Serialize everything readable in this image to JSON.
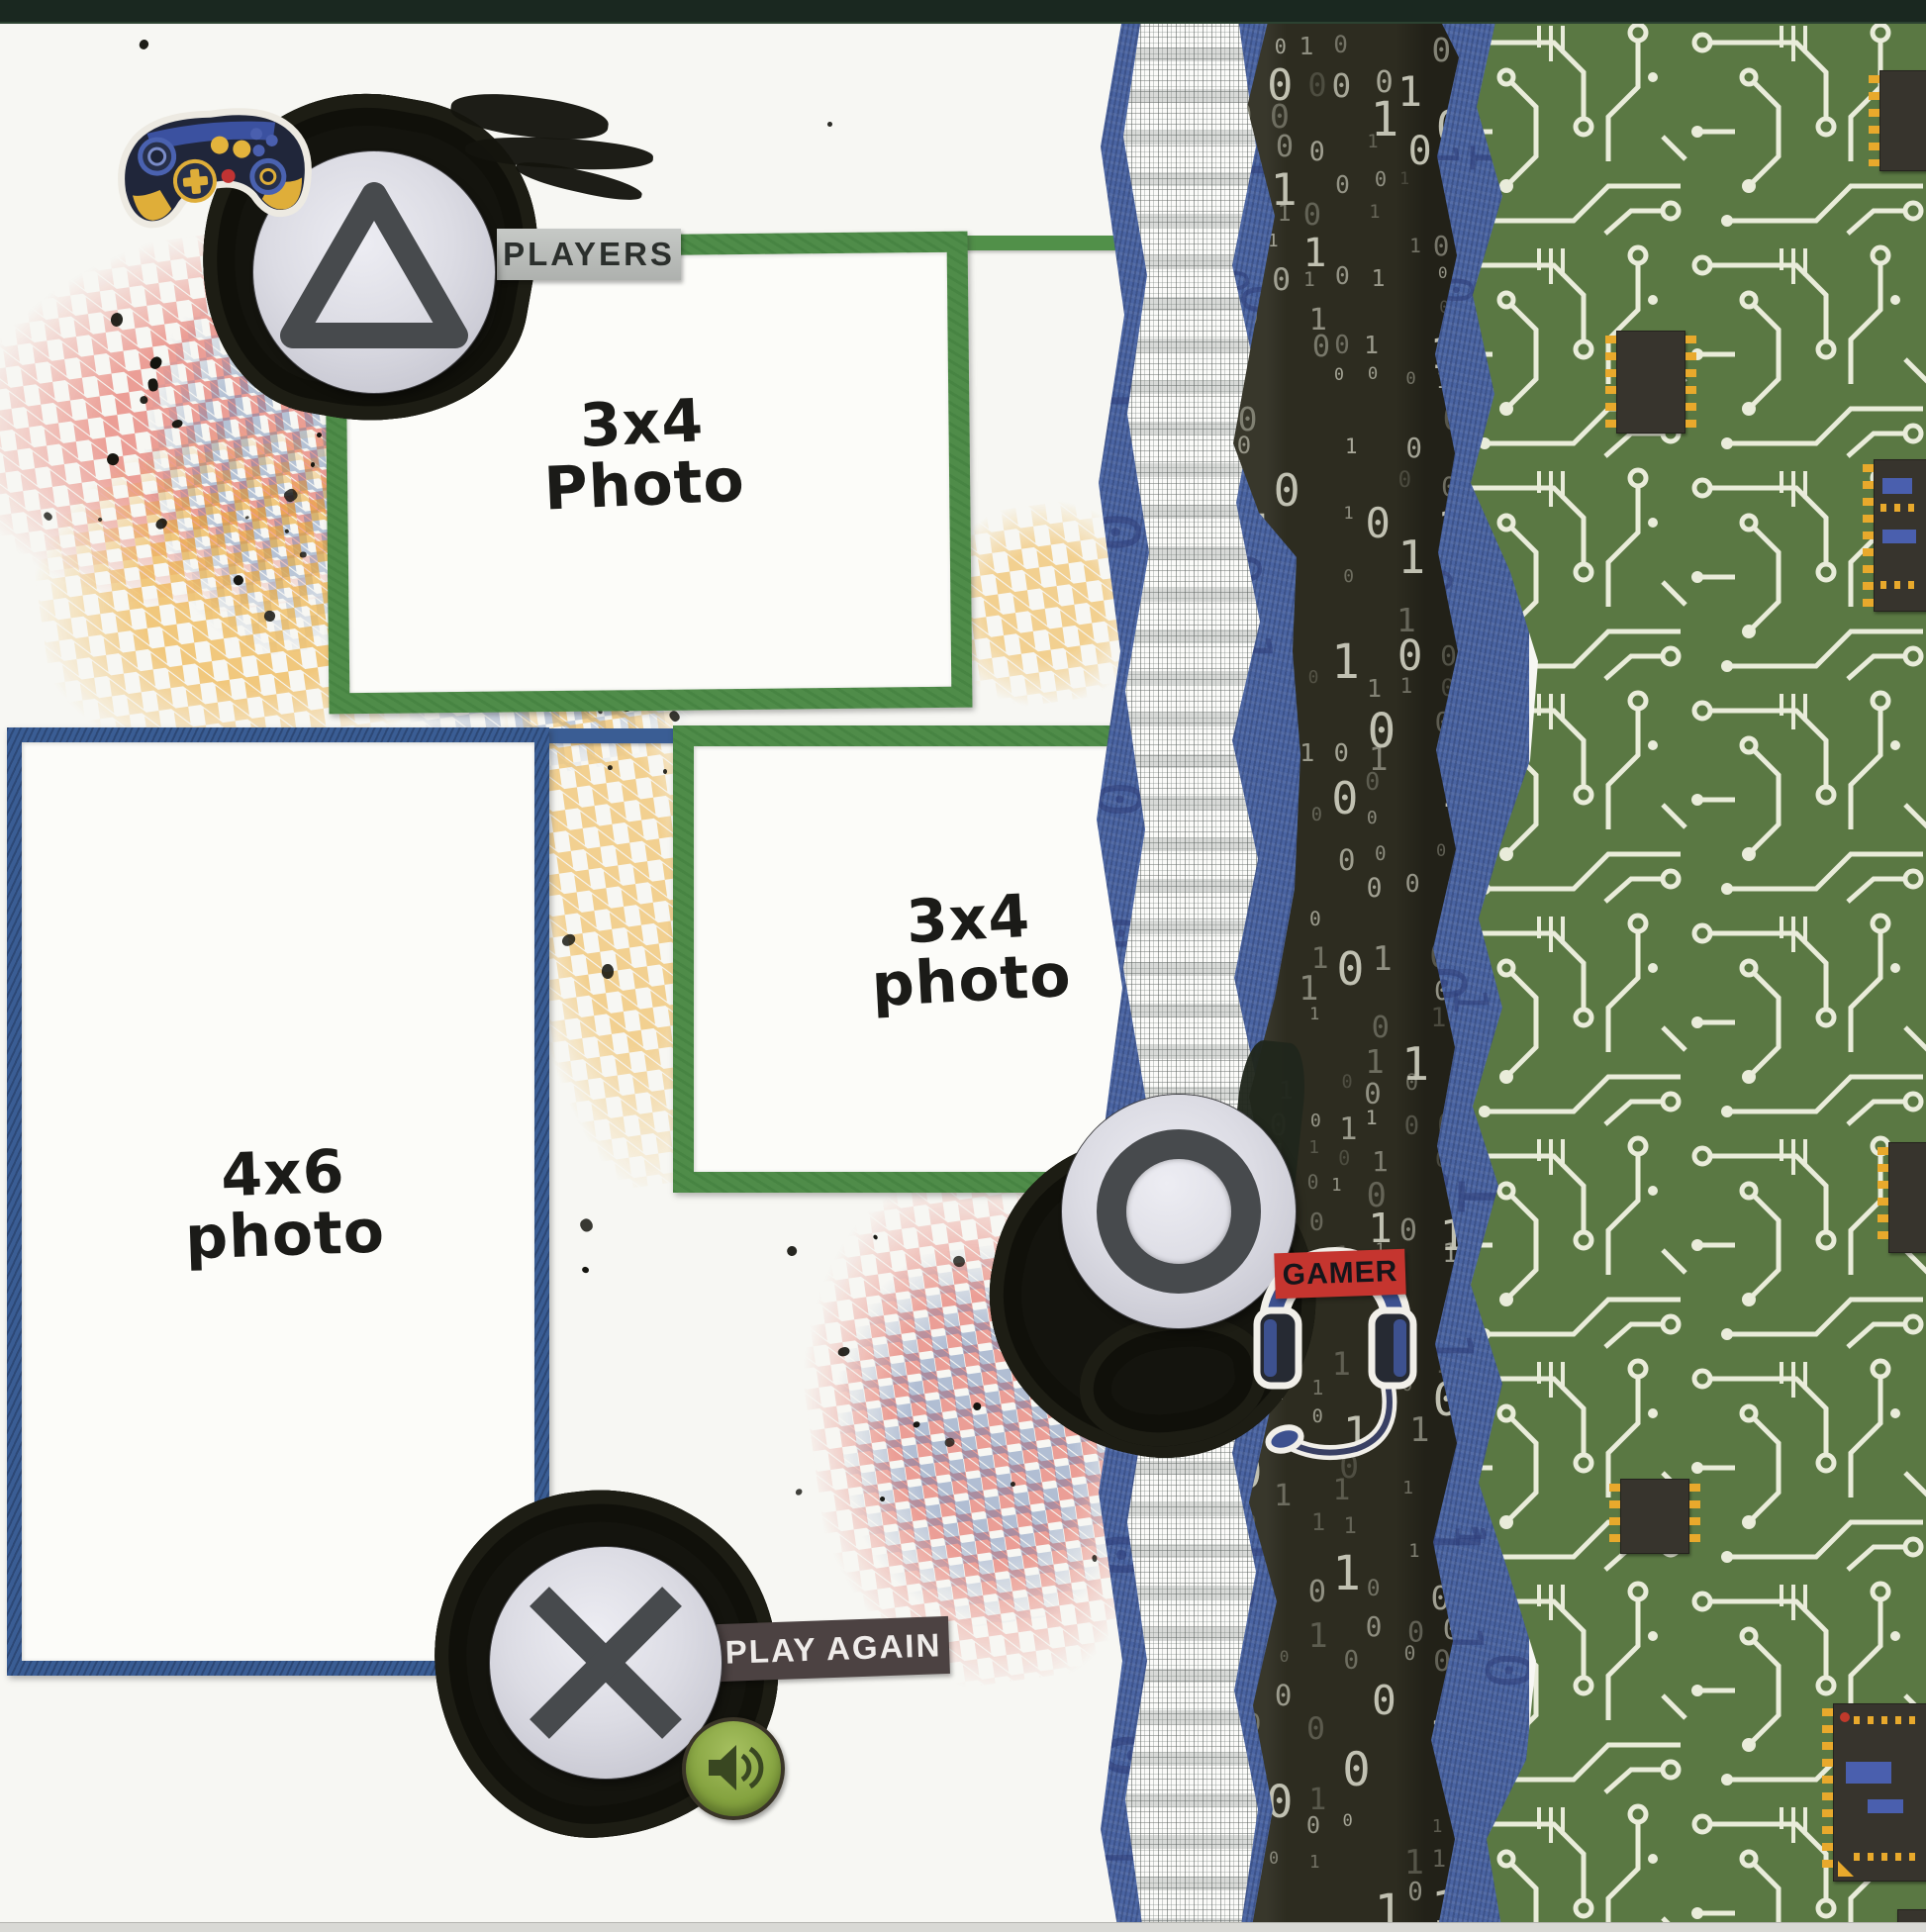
{
  "page_type": "scrapbook-layout-scan",
  "tags": {
    "players": "PLAYERS",
    "play_again": "PLAY AGAIN",
    "gamer": "GAMER"
  },
  "photos": [
    {
      "line1": "3x4",
      "line2": "Photo"
    },
    {
      "line1": "3x4",
      "line2": "photo"
    },
    {
      "line1": "4x6",
      "line2": "photo"
    }
  ],
  "pattern_chars": [
    "0",
    "1"
  ],
  "icons": [
    "triangle-button-icon",
    "circle-button-icon",
    "x-button-icon",
    "speaker-icon",
    "game-controller-icon",
    "headphones-icon"
  ],
  "colors": {
    "mat_green": "#4f8c49",
    "mat_blue": "#3a5d94",
    "torn_blue_paper": "#4a64a2",
    "binary_paper": "#2d2c20",
    "binary_digit": "#c9c9ba",
    "circuit_green": "#5a7843",
    "circuit_trace": "#e9ecda",
    "chip_pin_yellow": "#e8a92c",
    "gamer_red": "#c5352f",
    "players_gray": "#b8bbb8",
    "play_again_brown": "#4c4242",
    "speaker_green": "#84a23f",
    "stamp_red": "#e2574a",
    "stamp_yellow": "#eda92f",
    "stamp_blue": "#5b79ad",
    "paint_black": "#14140e"
  }
}
